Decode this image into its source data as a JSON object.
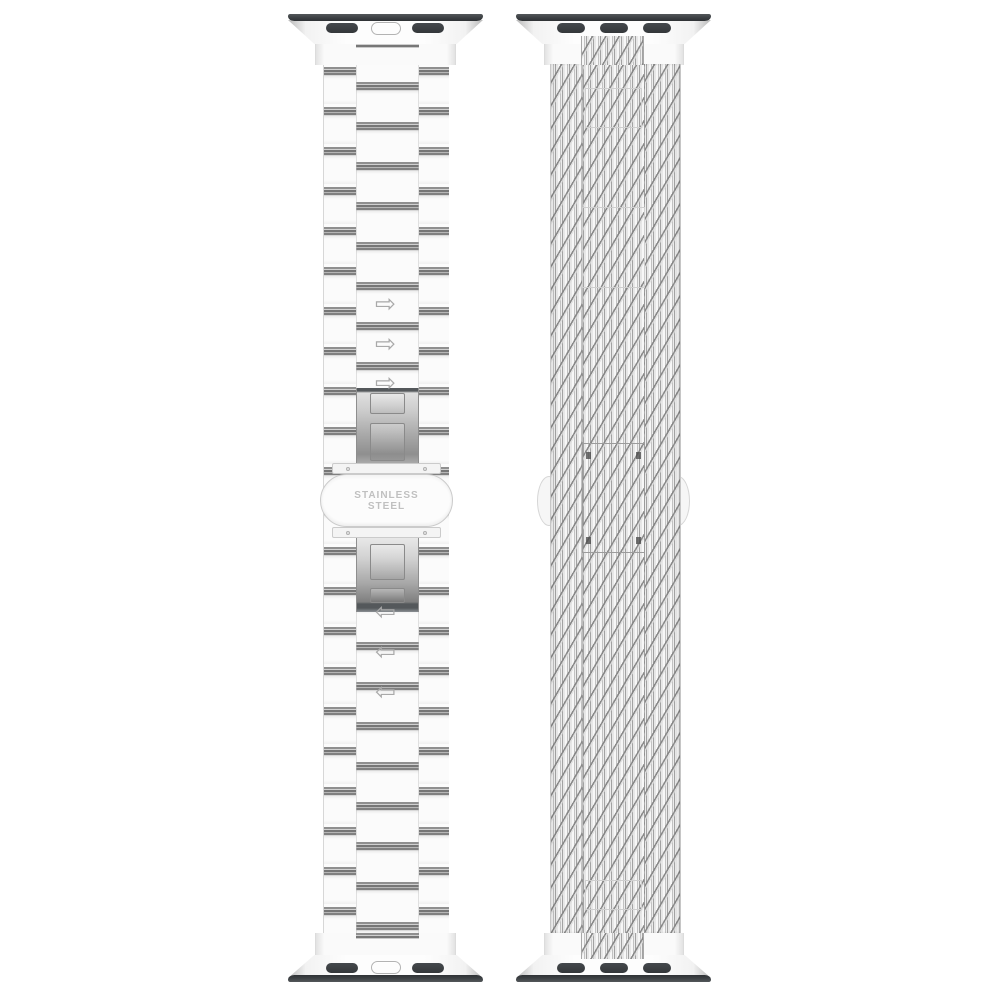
{
  "page": {
    "background_color": "#ffffff",
    "description": "Product render of two silver Apple Watch replacement bands shown vertically side by side"
  },
  "left_band": {
    "type": "Stainless steel three-link bracelet with butterfly clasp",
    "engraving": {
      "line1": "STAINLESS",
      "line2": "STEEL"
    },
    "arrow_up_glyph": "⇨",
    "arrow_down_glyph": "⇦",
    "arrows_above_clasp": 3,
    "arrows_below_clasp": 3,
    "connector_slot_count": 2,
    "has_release_button_pill": true
  },
  "right_band": {
    "type": "Woven mesh loop band with hidden sliding clasp",
    "connector_slot_count": 3
  },
  "colors": {
    "band_fill": "#fbfbfb",
    "outline": "#d7d7d7",
    "connector_bar": "#3c4043",
    "connector_slot": "#3b3e41",
    "link_stripe_dark": "#767676",
    "clasp_metal_light": "#e0e0e0",
    "clasp_metal_dark": "#54585b",
    "engraving_text": "#c0c0c0",
    "arrow": "#a9a9a9",
    "mesh_diagonal": "#848484"
  }
}
